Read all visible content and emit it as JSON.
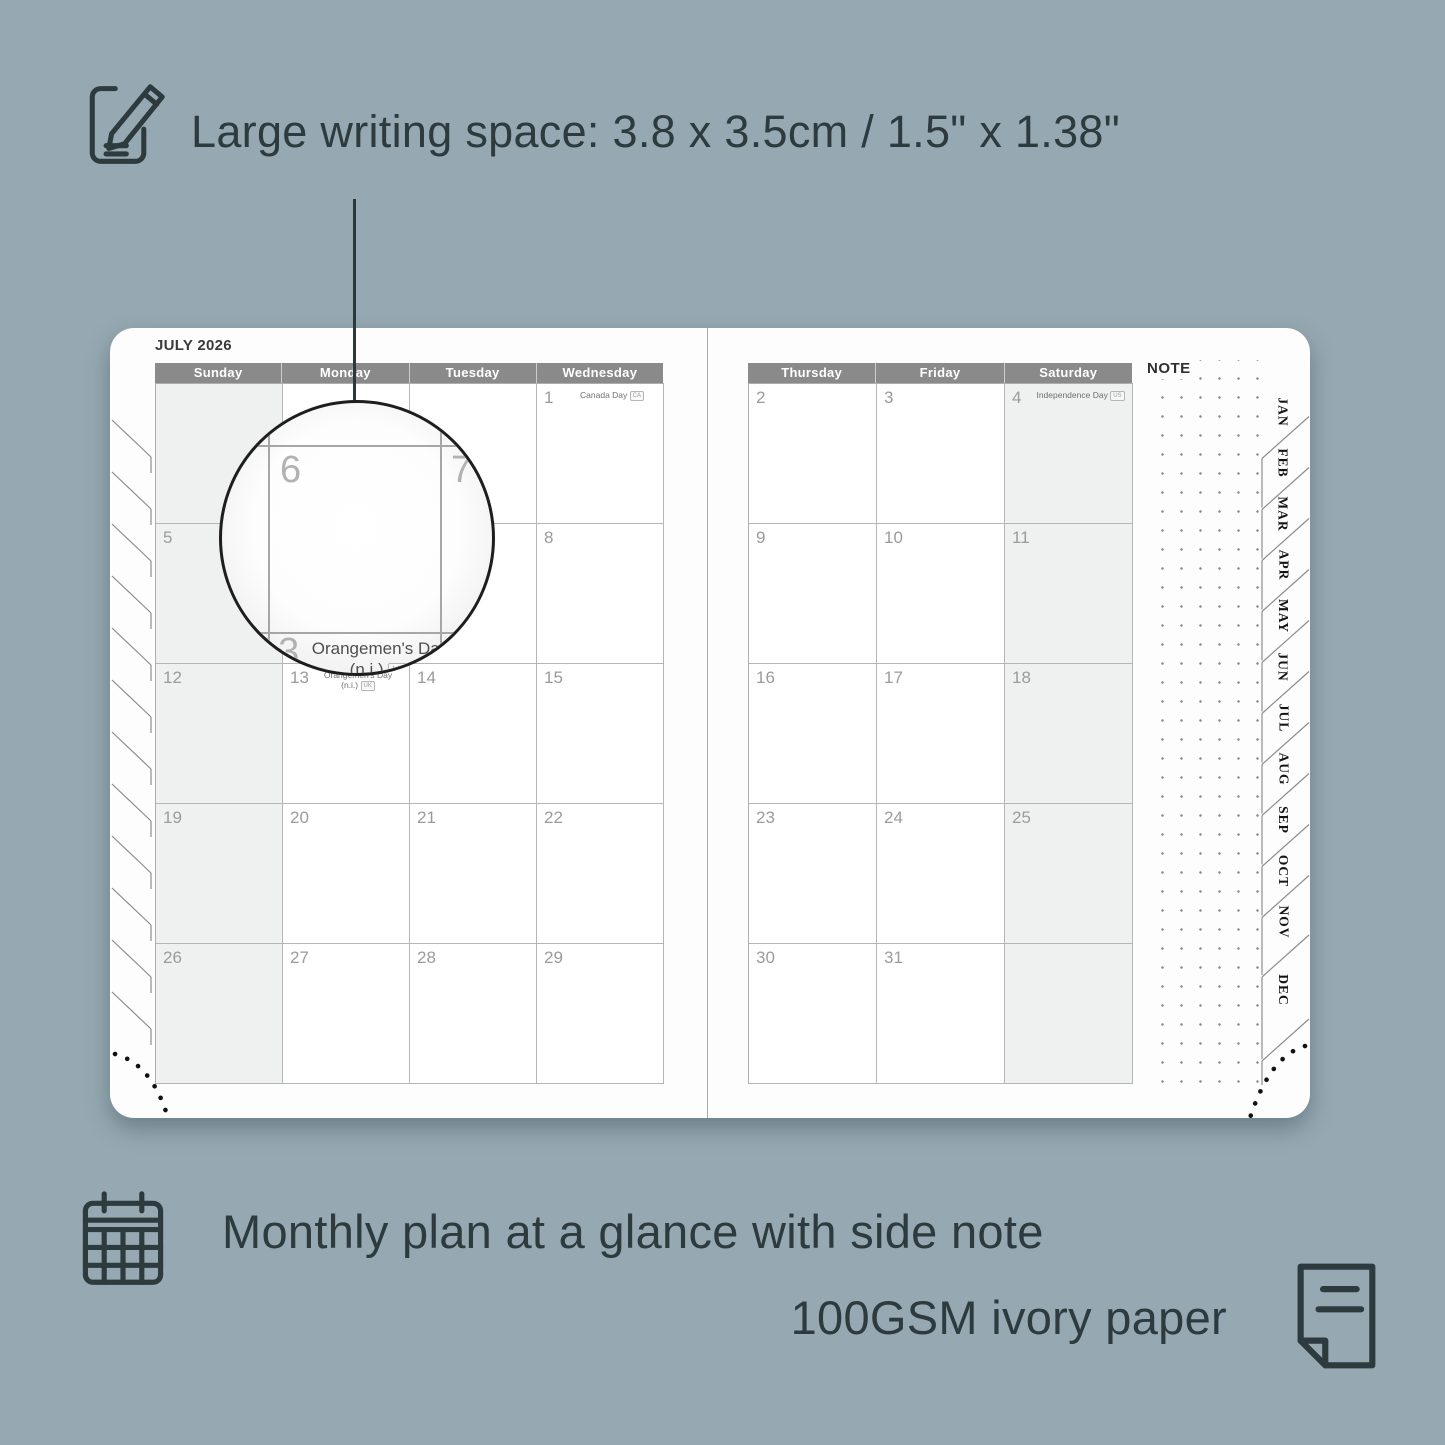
{
  "background_color": "#96a9b2",
  "accent_text_color": "#2d3b3f",
  "features": {
    "writing_space": {
      "label": "Large writing space: 3.8 x 3.5cm / 1.5\" x 1.38\"",
      "icon": "pencil-note-icon"
    },
    "monthly_plan": {
      "label": "Monthly plan at a glance with side note",
      "icon": "calendar-grid-icon"
    },
    "paper": {
      "label": "100GSM ivory paper",
      "icon": "paper-sheet-icon"
    }
  },
  "planner": {
    "month_title": "JULY 2026",
    "note_label": "NOTE",
    "header_bar_color": "#8a8a8a",
    "left_page_day_headers": [
      "Sunday",
      "Monday",
      "Tuesday",
      "Wednesday"
    ],
    "right_page_day_headers": [
      "Thursday",
      "Friday",
      "Saturday"
    ],
    "month_tabs": [
      "JAN",
      "FEB",
      "MAR",
      "APR",
      "MAY",
      "JUN",
      "JUL",
      "AUG",
      "SEP",
      "OCT",
      "NOV",
      "DEC"
    ],
    "left_page_grid": [
      [
        {
          "day": ""
        },
        {
          "day": ""
        },
        {
          "day": ""
        },
        {
          "day": "1",
          "holiday": "Canada Day",
          "badge": "CA"
        }
      ],
      [
        {
          "day": "5"
        },
        {
          "day": "6"
        },
        {
          "day": "7"
        },
        {
          "day": "8"
        }
      ],
      [
        {
          "day": "12"
        },
        {
          "day": "13",
          "holiday": "Orangemen's Day\n(n.i.)",
          "badge": "UK"
        },
        {
          "day": "14"
        },
        {
          "day": "15"
        }
      ],
      [
        {
          "day": "19"
        },
        {
          "day": "20"
        },
        {
          "day": "21"
        },
        {
          "day": "22"
        }
      ],
      [
        {
          "day": "26"
        },
        {
          "day": "27"
        },
        {
          "day": "28"
        },
        {
          "day": "29"
        }
      ]
    ],
    "right_page_grid": [
      [
        {
          "day": "2"
        },
        {
          "day": "3"
        },
        {
          "day": "4",
          "holiday": "Independence Day",
          "badge": "US"
        }
      ],
      [
        {
          "day": "9"
        },
        {
          "day": "10"
        },
        {
          "day": "11"
        }
      ],
      [
        {
          "day": "16"
        },
        {
          "day": "17"
        },
        {
          "day": "18"
        }
      ],
      [
        {
          "day": "23"
        },
        {
          "day": "24"
        },
        {
          "day": "25"
        }
      ],
      [
        {
          "day": "30"
        },
        {
          "day": "31"
        },
        {
          "day": ""
        }
      ]
    ],
    "magnifier": {
      "day_top_left": "6",
      "day_top_right": "7",
      "day_bottom": "13",
      "holiday_line1": "Orangemen's Day",
      "holiday_line2": "(n.i.)",
      "badge": "UK"
    }
  }
}
